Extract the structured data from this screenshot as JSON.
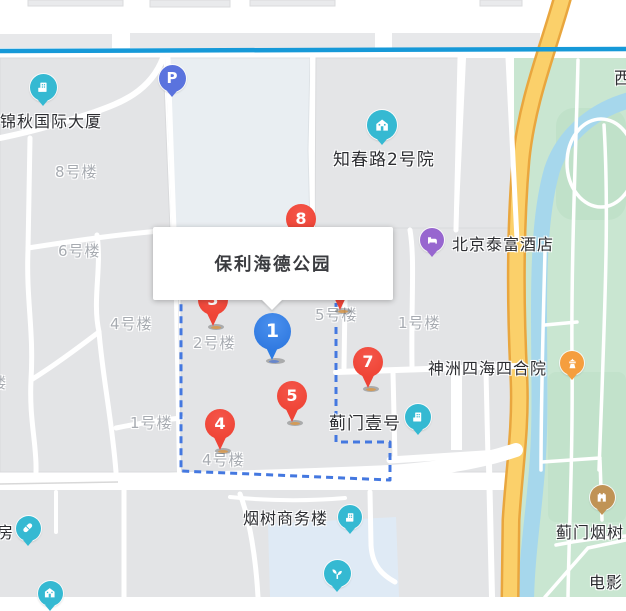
{
  "map": {
    "popup": {
      "title": "保利海德公园"
    },
    "colors": {
      "metro_line": "#1699d8",
      "boundary_dash": "#4478e0",
      "red_pin": "#ee4437",
      "blue_pin": "#2c7ce4",
      "teal_poi": "#35b9d2",
      "purple_poi": "#9766cf",
      "orange_poi": "#f59e3e",
      "tan_poi": "#c09355",
      "indigo_poi": "#5a73de",
      "park_green": "#c9e6d1",
      "river_blue": "#a6d7ec",
      "road_yellow": "#fbd06a"
    },
    "pins": [
      {
        "num": "8",
        "type": "red",
        "x": 301,
        "y": 219
      },
      {
        "num": "3",
        "type": "red",
        "x": 213,
        "y": 300
      },
      {
        "num": "",
        "type": "red",
        "x": 340,
        "y": 284
      },
      {
        "num": "7",
        "type": "red",
        "x": 368,
        "y": 362
      },
      {
        "num": "1",
        "type": "blue",
        "x": 272,
        "y": 331
      },
      {
        "num": "5",
        "type": "red",
        "x": 292,
        "y": 396
      },
      {
        "num": "4",
        "type": "red",
        "x": 220,
        "y": 424
      }
    ],
    "pois": [
      {
        "id": "parking",
        "icon": "parking-icon",
        "glyph": "P",
        "color": "#5a73de",
        "x": 172,
        "y": 78,
        "size": 27
      },
      {
        "id": "jinqiu-tower",
        "icon": "building-icon",
        "color": "#35b9d2",
        "x": 43,
        "y": 87,
        "size": 27,
        "label": "锦秋国际大厦",
        "lx": 0,
        "ly": 108,
        "lsize": 16
      },
      {
        "id": "zhichunlu-2",
        "icon": "house-icon",
        "color": "#35b9d2",
        "x": 382,
        "y": 125,
        "size": 30,
        "label": "知春路2号院",
        "lx": 333,
        "ly": 145,
        "lsize": 17
      },
      {
        "id": "taifu-hotel",
        "icon": "hotel-icon",
        "color": "#9766cf",
        "x": 432,
        "y": 240,
        "size": 24,
        "label": "北京泰富酒店",
        "lx": 452,
        "ly": 231,
        "lsize": 16
      },
      {
        "id": "shenzhou-siheyuan",
        "icon": "attraction-icon",
        "color": "#f59e3e",
        "x": 572,
        "y": 363,
        "size": 24,
        "label": "神洲四海四合院",
        "lx": 428,
        "ly": 355,
        "lsize": 16
      },
      {
        "id": "jimen-yihao",
        "icon": "building-icon",
        "color": "#35b9d2",
        "x": 418,
        "y": 417,
        "size": 26,
        "label": "蓟门壹号",
        "lx": 329,
        "ly": 409,
        "lsize": 17
      },
      {
        "id": "yanshu-office",
        "icon": "building-icon",
        "color": "#35b9d2",
        "x": 350,
        "y": 517,
        "size": 24,
        "label": "烟树商务楼",
        "lx": 243,
        "ly": 505,
        "lsize": 16
      },
      {
        "id": "pharmacy",
        "icon": "pill-icon",
        "color": "#35b9d2",
        "x": 28,
        "y": 528,
        "size": 25,
        "label": "房",
        "lx": -3,
        "ly": 519,
        "lsize": 16
      },
      {
        "id": "poi-house",
        "icon": "house-icon",
        "color": "#35b9d2",
        "x": 50,
        "y": 593,
        "size": 25
      },
      {
        "id": "poi-sprout",
        "icon": "sprout-icon",
        "color": "#35b9d2",
        "x": 337,
        "y": 573,
        "size": 27
      },
      {
        "id": "jimen-yanshu",
        "icon": "castle-icon",
        "color": "#c09355",
        "x": 602,
        "y": 497,
        "size": 25,
        "label": "蓟门烟树",
        "lx": 556,
        "ly": 519,
        "lsize": 16
      }
    ],
    "area_labels": [
      {
        "text": "8号楼",
        "x": 55,
        "y": 161
      },
      {
        "text": "6号楼",
        "x": 58,
        "y": 240
      },
      {
        "text": "4号楼",
        "x": 110,
        "y": 313
      },
      {
        "text": "楼",
        "x": -9,
        "y": 372
      },
      {
        "text": "1号楼",
        "x": 130,
        "y": 412
      },
      {
        "text": "2号楼",
        "x": 193,
        "y": 332
      },
      {
        "text": "5号楼",
        "x": 315,
        "y": 304
      },
      {
        "text": "1号楼",
        "x": 398,
        "y": 312
      },
      {
        "text": "4号楼",
        "x": 202,
        "y": 449
      }
    ],
    "street_labels": [
      {
        "text": "西",
        "x": 614,
        "y": 64,
        "size": 17
      },
      {
        "text": "电影",
        "x": 589,
        "y": 569,
        "size": 16
      }
    ]
  }
}
